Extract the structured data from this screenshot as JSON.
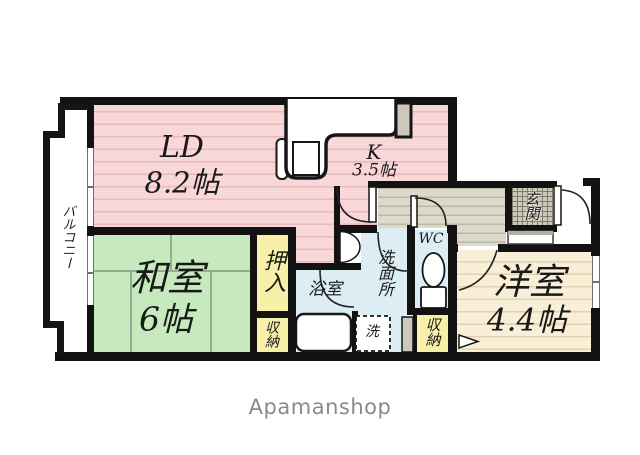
{
  "floorplan": {
    "balcony_label": "バルコニー",
    "rooms": {
      "ld": {
        "name": "LD",
        "size": "8.2帖"
      },
      "kitchen": {
        "name": "K",
        "size": "3.5帖"
      },
      "japanese_room": {
        "name": "和室",
        "size": "6帖"
      },
      "western_room": {
        "name": "洋室",
        "size": "4.4帖"
      },
      "bathroom": "浴室",
      "washroom": "洗面所",
      "toilet": "WC",
      "laundry": "洗",
      "entrance": "玄関",
      "closet": "押入",
      "storage_left": "収納",
      "storage_right": "収納"
    },
    "footer_brand": "Apamanshop",
    "colors": {
      "ld_kitchen_floor": "#f8d7d8",
      "japanese_room_floor": "#c6e9bd",
      "western_room_floor": "#f9efd8",
      "closet_fill": "#f7f0a8",
      "wet_area_fill": "#ddedf4",
      "hallway_fill": "#dedacb",
      "entrance_tile": "#ccc8b8",
      "wall": "#121212",
      "brand_text": "#8a8a8a"
    }
  }
}
